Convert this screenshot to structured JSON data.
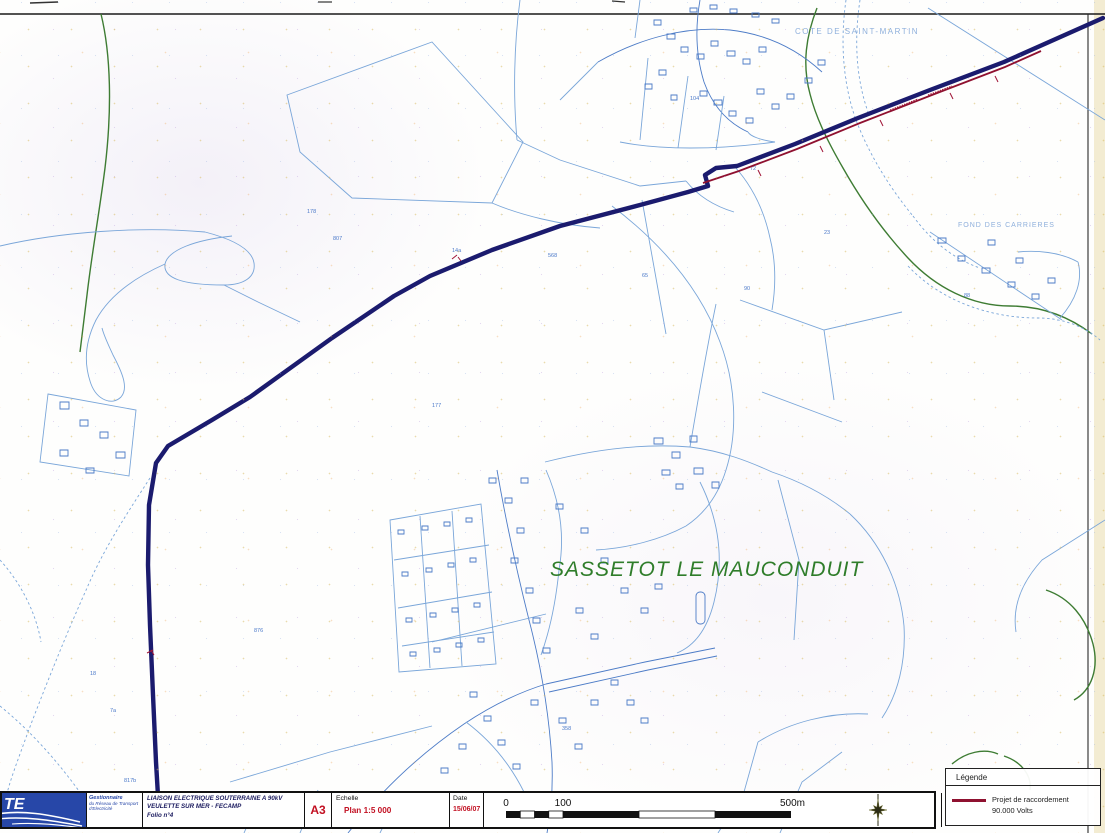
{
  "map": {
    "place_labels": {
      "town": "SASSETOT LE MAUCONDUIT",
      "hill": "COTE DE SAINT-MARTIN",
      "quarry": "FOND DES CARRIERES"
    },
    "parcel_numbers": [
      {
        "t": "178"
      },
      {
        "t": "807"
      },
      {
        "t": "14a"
      },
      {
        "t": "18"
      },
      {
        "t": "817b"
      },
      {
        "t": "568"
      },
      {
        "t": "90"
      },
      {
        "t": "65"
      },
      {
        "t": "177"
      },
      {
        "t": "876"
      },
      {
        "t": "7a"
      },
      {
        "t": "23"
      },
      {
        "t": "88"
      },
      {
        "t": "358"
      },
      {
        "t": "104"
      },
      {
        "t": "72"
      }
    ],
    "colors": {
      "route_navy": "#1b1b6e",
      "project_red": "#8f1130",
      "cadastral_blue": "#7aa6d9",
      "terrain_green": "#3e7c33",
      "town_label_green": "#2f7d2a",
      "rte_blue": "#2747a8"
    }
  },
  "title_block": {
    "logo_text": "TE",
    "operator_line1": "Gestionnaire",
    "operator_line2": "du Réseau de Transport d'Electricité",
    "project_line1": "LIAISON ELECTRIQUE SOUTERRAINE A 90kV",
    "project_line2": "VEULETTE SUR MER - FECAMP",
    "project_line3": "Folio n°4",
    "format": "A3",
    "scale_label": "Echelle",
    "scale_value": "Plan 1:5 000",
    "date_label": "Date",
    "date_value": "15/06/07"
  },
  "scale_bar": {
    "tick0": "0",
    "tick100": "100",
    "tick500": "500m"
  },
  "legend": {
    "title": "Légende",
    "item_line1": "Projet de raccordement",
    "item_line2": "90.000 Volts"
  }
}
